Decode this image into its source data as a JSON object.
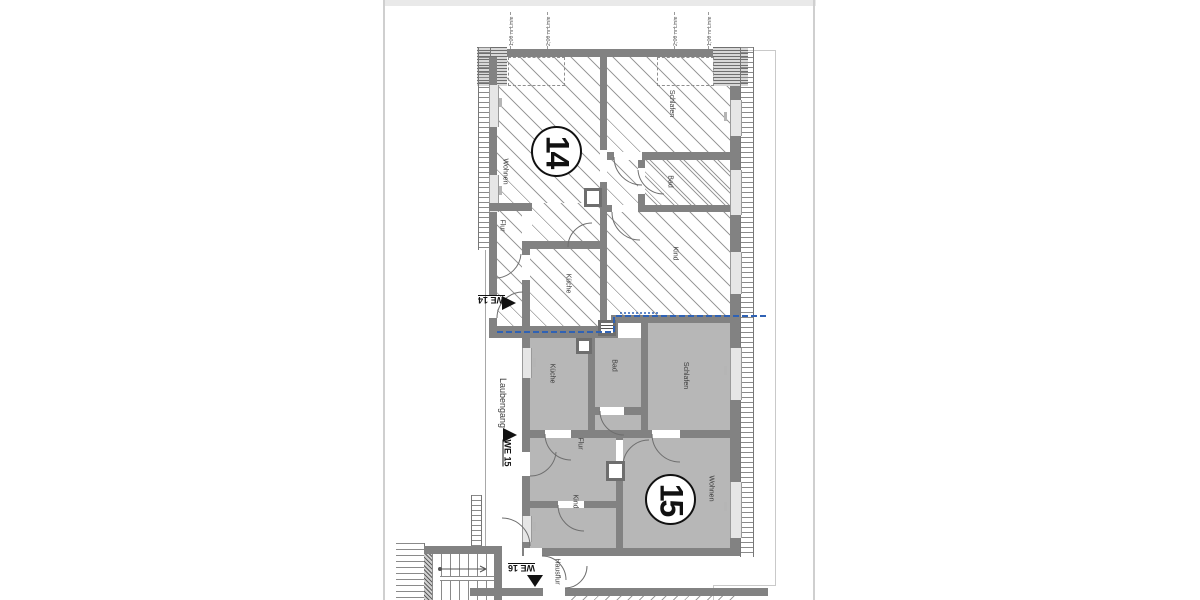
{
  "document": {
    "type_label": "floor plan scan"
  },
  "colors": {
    "wall": "#828282",
    "apartment15_fill": "#b7b7b7",
    "hatch_line": "#9b9b9b",
    "section_line_blue": "#2f62b5",
    "ink": "#1a1a1a"
  },
  "height_lines": {
    "l1": "1,00 m Linie",
    "l2": "2,00 m Linie",
    "l3": "2,00 m Linie",
    "l4": "1,00 m Linie"
  },
  "apt14": {
    "number": "14",
    "entrance": "WE 14",
    "rooms": {
      "wohnen": "Wohnen",
      "flur": "Flur",
      "kueche": "Küche",
      "schlafen": "Schlafen",
      "bad": "Bad",
      "kind": "Kind"
    }
  },
  "apt15": {
    "number": "15",
    "entrance": "WE 15",
    "rooms": {
      "kueche": "Küche",
      "bad": "Bad",
      "schlafen": "Schlafen",
      "flur": "Flur",
      "kind": "Kind",
      "wohnen": "Wohnen"
    }
  },
  "common": {
    "walkway": "Laubengang",
    "corridor": "Hausflur",
    "unit16": "WE 16"
  }
}
